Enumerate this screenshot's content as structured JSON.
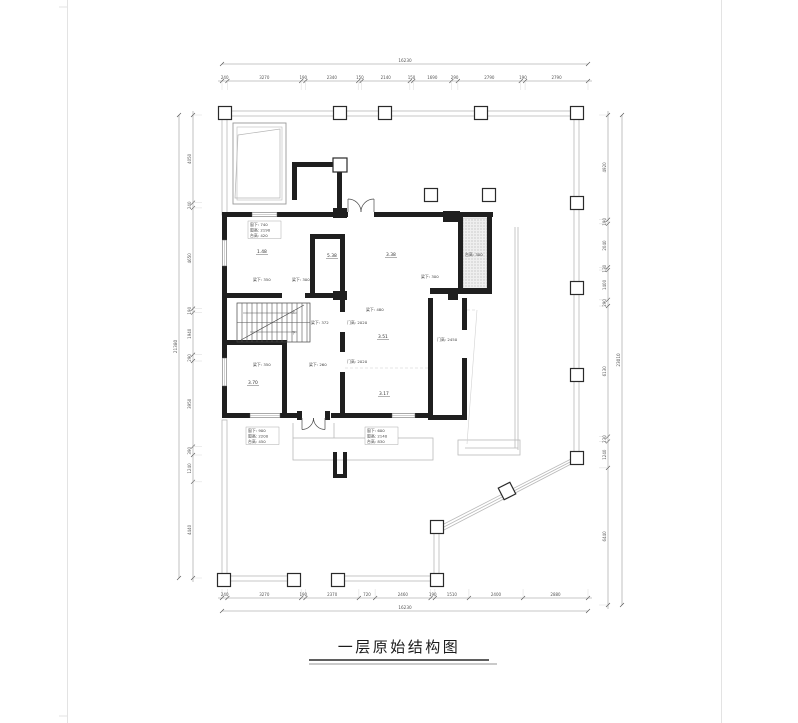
{
  "title": {
    "text": "一层原始结构图"
  },
  "plan": {
    "beam_labels": [
      {
        "text": "梁下: 350",
        "x": 253,
        "y": 281
      },
      {
        "text": "梁下: 300",
        "x": 292,
        "y": 281
      },
      {
        "text": "梁下: 372",
        "x": 311,
        "y": 324
      },
      {
        "text": "梁下: 480",
        "x": 366,
        "y": 311
      },
      {
        "text": "梁下: 350",
        "x": 253,
        "y": 366
      },
      {
        "text": "梁下: 260",
        "x": 309,
        "y": 366
      },
      {
        "text": "梁下: 300",
        "x": 421,
        "y": 278
      },
      {
        "text": "门高: 2020",
        "x": 347,
        "y": 324
      },
      {
        "text": "门高: 2020",
        "x": 347,
        "y": 363
      },
      {
        "text": "门高: 2450",
        "x": 437,
        "y": 341
      },
      {
        "text": "台高: 300",
        "x": 465,
        "y": 256
      }
    ],
    "level_labels": [
      {
        "text": "1.48",
        "x": 257,
        "y": 253
      },
      {
        "text": "5.38",
        "x": 327,
        "y": 257
      },
      {
        "text": "3.38",
        "x": 386,
        "y": 256
      },
      {
        "text": "3.70",
        "x": 248,
        "y": 384
      },
      {
        "text": "3.51",
        "x": 378,
        "y": 338
      },
      {
        "text": "3.17",
        "x": 379,
        "y": 395
      }
    ],
    "stair_labels": [
      {
        "text": "上",
        "x": 292,
        "y": 313
      },
      {
        "text": "下",
        "x": 292,
        "y": 334
      }
    ],
    "info_blocks": [
      {
        "x": 250,
        "y": 226,
        "lines": [
          "窗下: 740",
          "窗高: 2190",
          "台高: 420"
        ]
      },
      {
        "x": 248,
        "y": 432,
        "lines": [
          "窗下: 900",
          "窗高: 2200",
          "台高: 450"
        ]
      },
      {
        "x": 367,
        "y": 432,
        "lines": [
          "窗下: 600",
          "窗高: 2140",
          "台高: 830"
        ]
      }
    ]
  },
  "dimensions": {
    "top": {
      "total": "16230",
      "segments": [
        "240",
        "3270",
        "190",
        "2340",
        "150",
        "2140",
        "150",
        "1690",
        "290",
        "2790",
        "190",
        "2790"
      ]
    },
    "bottom": {
      "total": "16230",
      "segments": [
        "240",
        "3270",
        "190",
        "2370",
        "720",
        "2460",
        "190",
        "1510",
        "2400",
        "2880"
      ]
    },
    "left": {
      "total": "21380",
      "segments": [
        "4050",
        "240",
        "4650",
        "190",
        "1940",
        "290",
        "3950",
        "390",
        "1240",
        "4440"
      ]
    },
    "right": {
      "total": "23010",
      "segments": [
        "4920",
        "190",
        "2040",
        "130",
        "1400",
        "290",
        "6130",
        "230",
        "1240",
        "6440"
      ]
    }
  }
}
